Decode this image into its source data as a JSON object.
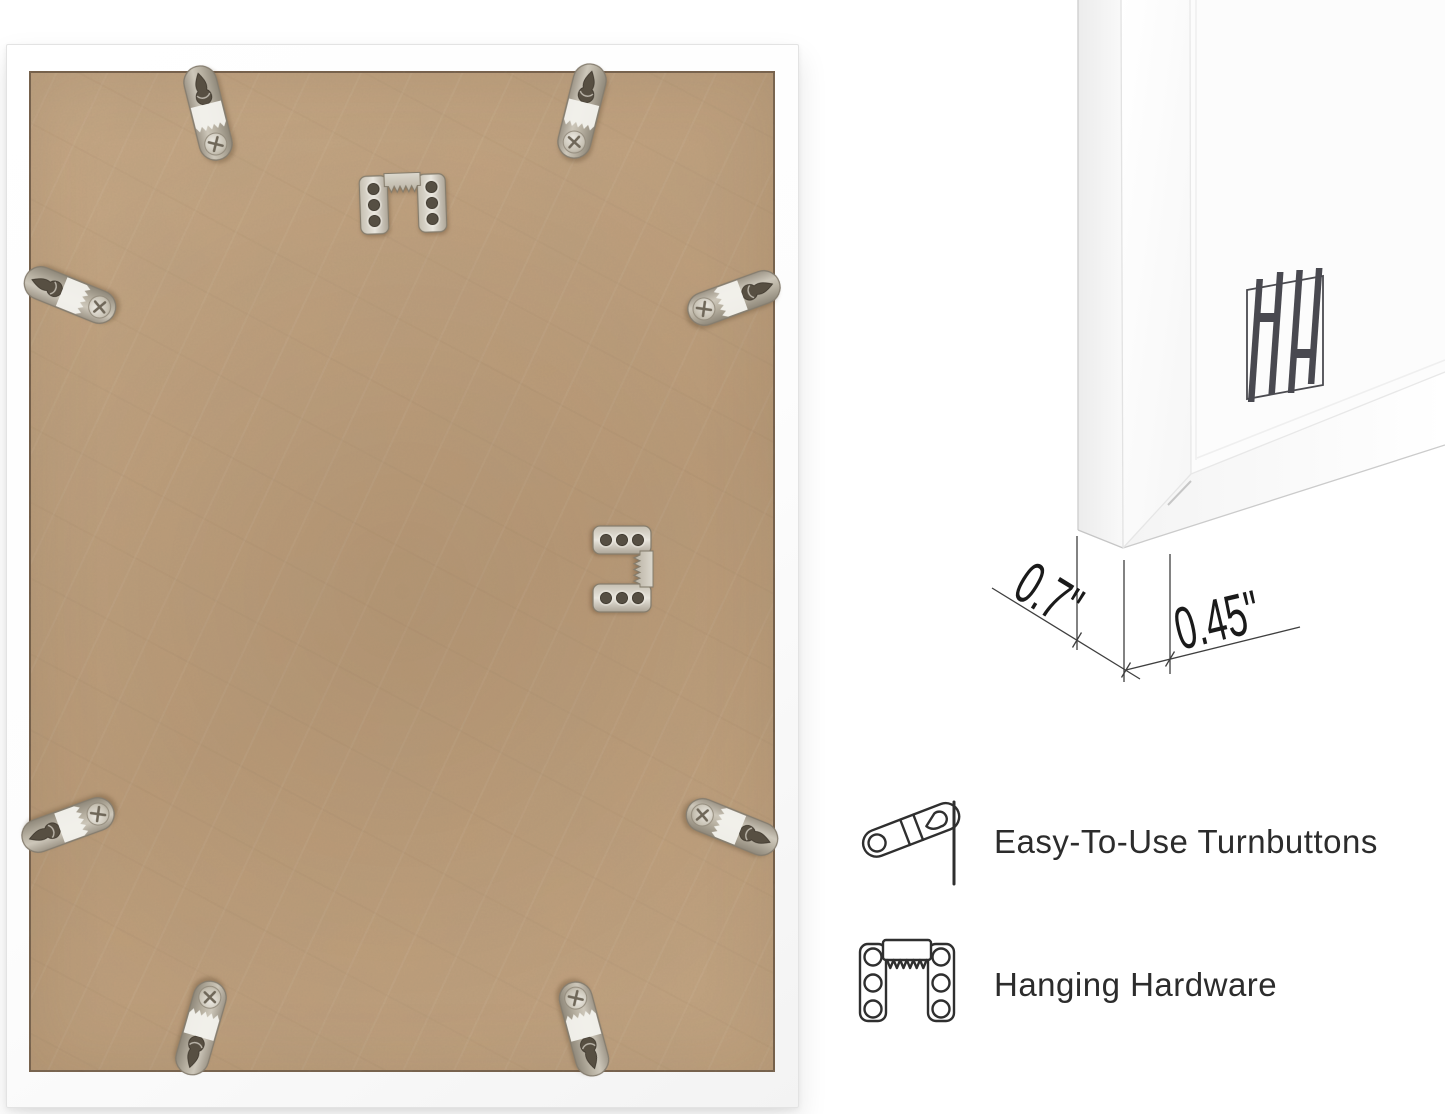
{
  "frame_back": {
    "backing_color": "#c2a17e",
    "frame_color": "#ffffff",
    "turnbutton_count": 8,
    "sawtooth_hanger_count": 2
  },
  "corner_closeup": {
    "depth_label": "0.7\"",
    "face_width_label": "0.45\"",
    "logo_text": "HH",
    "logo_color": "#4b4b50"
  },
  "features": [
    {
      "icon": "turnbutton-icon",
      "label": "Easy-To-Use Turnbuttons"
    },
    {
      "icon": "hanging-hardware-icon",
      "label": "Hanging Hardware"
    }
  ],
  "colors": {
    "page_background": "#ffffff",
    "feature_text": "#2c2c2c",
    "dimension_text": "#1a1a1a",
    "icon_stroke": "#2f2f2f",
    "hardware_metal": "#c6c0b2"
  }
}
